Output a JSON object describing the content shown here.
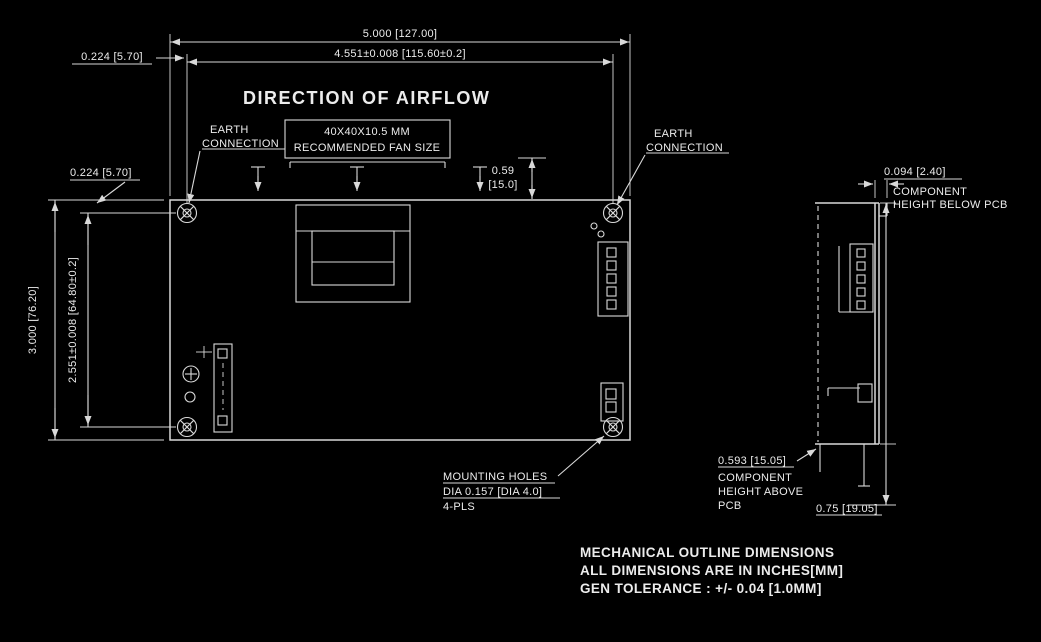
{
  "colors": {
    "background": "#000000",
    "line": "#d9d9d9",
    "text": "#ececec"
  },
  "top_view": {
    "airflow_label": "DIRECTION OF AIRFLOW",
    "dim_overall_width": "5.000 [127.00]",
    "dim_hole_span_horizontal": "4.551±0.008 [115.60±0.2]",
    "dim_overall_height": "3.000 [76.20]",
    "dim_hole_span_vertical": "2.551±0.008 [64.80±0.2]",
    "dim_hole_inset_top": "0.224 [5.70]",
    "dim_hole_inset_side": "0.224 [5.70]",
    "dim_fan_offset_value": "0.59",
    "dim_fan_offset_mm": "[15.0]",
    "fan_box_line1": "40X40X10.5 MM",
    "fan_box_line2": "RECOMMENDED FAN SIZE",
    "earth_left_line1": "EARTH",
    "earth_left_line2": "CONNECTION",
    "earth_right_line1": "EARTH",
    "earth_right_line2": "CONNECTION",
    "mounting_holes_line1": "MOUNTING HOLES",
    "mounting_holes_line2": "DIA 0.157 [DIA 4.0]",
    "mounting_holes_line3": "4-PLS"
  },
  "side_view": {
    "dim_below_pcb": "0.094 [2.40]",
    "below_pcb_line1": "COMPONENT",
    "below_pcb_line2": "HEIGHT BELOW PCB",
    "dim_above_pcb": "0.593 [15.05]",
    "above_pcb_line1": "COMPONENT",
    "above_pcb_line2": "HEIGHT ABOVE",
    "above_pcb_line3": "PCB",
    "dim_pin_length": "0.75 [19.05]"
  },
  "notes": {
    "line1": "MECHANICAL OUTLINE DIMENSIONS",
    "line2": "ALL DIMENSIONS ARE IN INCHES[MM]",
    "line3": "GEN TOLERANCE : +/- 0.04 [1.0MM]"
  }
}
